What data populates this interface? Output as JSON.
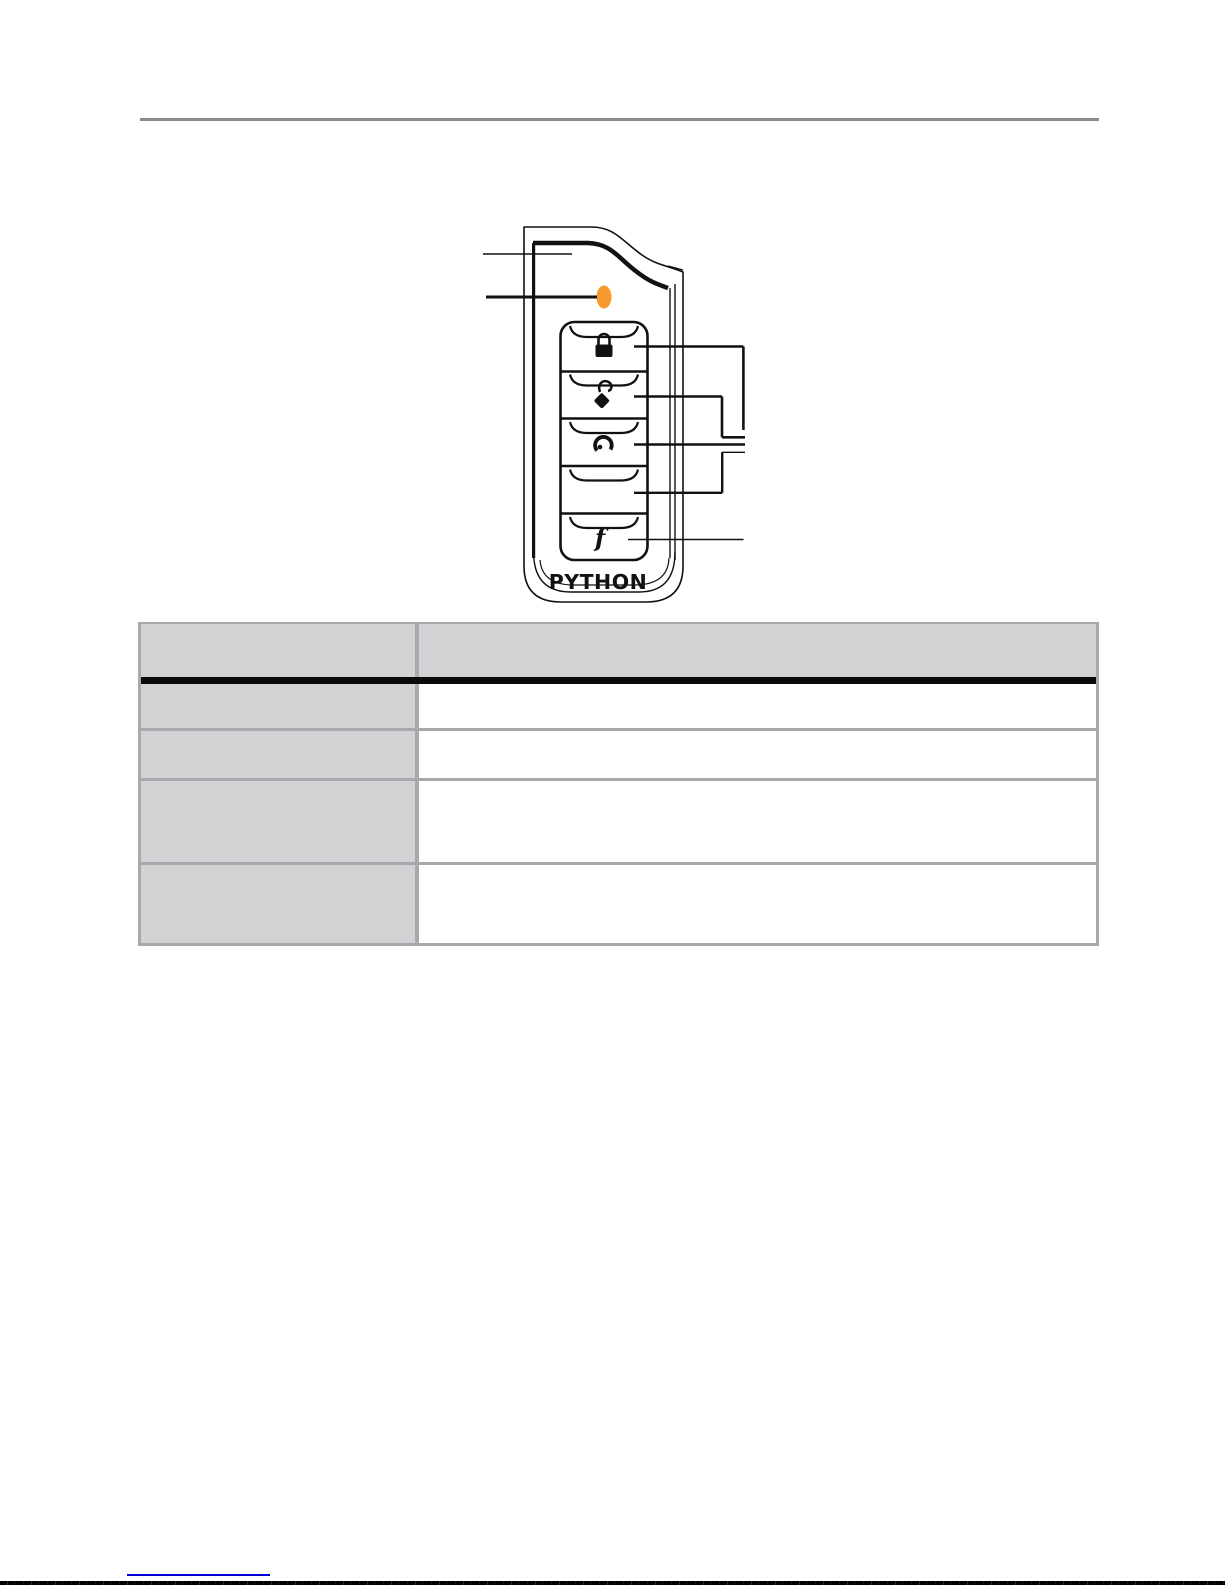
{
  "page": {
    "background": "#ffffff",
    "top_divider_color": "#8a8a8f"
  },
  "figure": {
    "device": "remote-transmitter-diagram",
    "brand_label": "PYTHON",
    "led_color": "#f7992c",
    "buttons": [
      {
        "name": "lock-button",
        "icon": "lock-icon",
        "label": ""
      },
      {
        "name": "unlock-button",
        "icon": "unlock-icon",
        "label": ""
      },
      {
        "name": "remote-start-button",
        "icon": "remote-start-icon",
        "label": ""
      },
      {
        "name": "aux-button",
        "icon": "none",
        "label": ""
      },
      {
        "name": "f-button",
        "icon": "f-glyph",
        "label": "f"
      }
    ],
    "callouts": {
      "left_count": 2,
      "right_count": 5
    }
  },
  "table": {
    "border_color": "#a8a8ad",
    "header_fill": "#d2d2d4",
    "header_separator_color": "#0a0a0a",
    "columns": [
      {
        "header": ""
      },
      {
        "header": ""
      }
    ],
    "rows": [
      {
        "label": "",
        "description": ""
      },
      {
        "label": "",
        "description": ""
      },
      {
        "label": "",
        "description": ""
      },
      {
        "label": "",
        "description": ""
      }
    ]
  },
  "footer": {
    "link_underline_color": "#0000d6"
  }
}
